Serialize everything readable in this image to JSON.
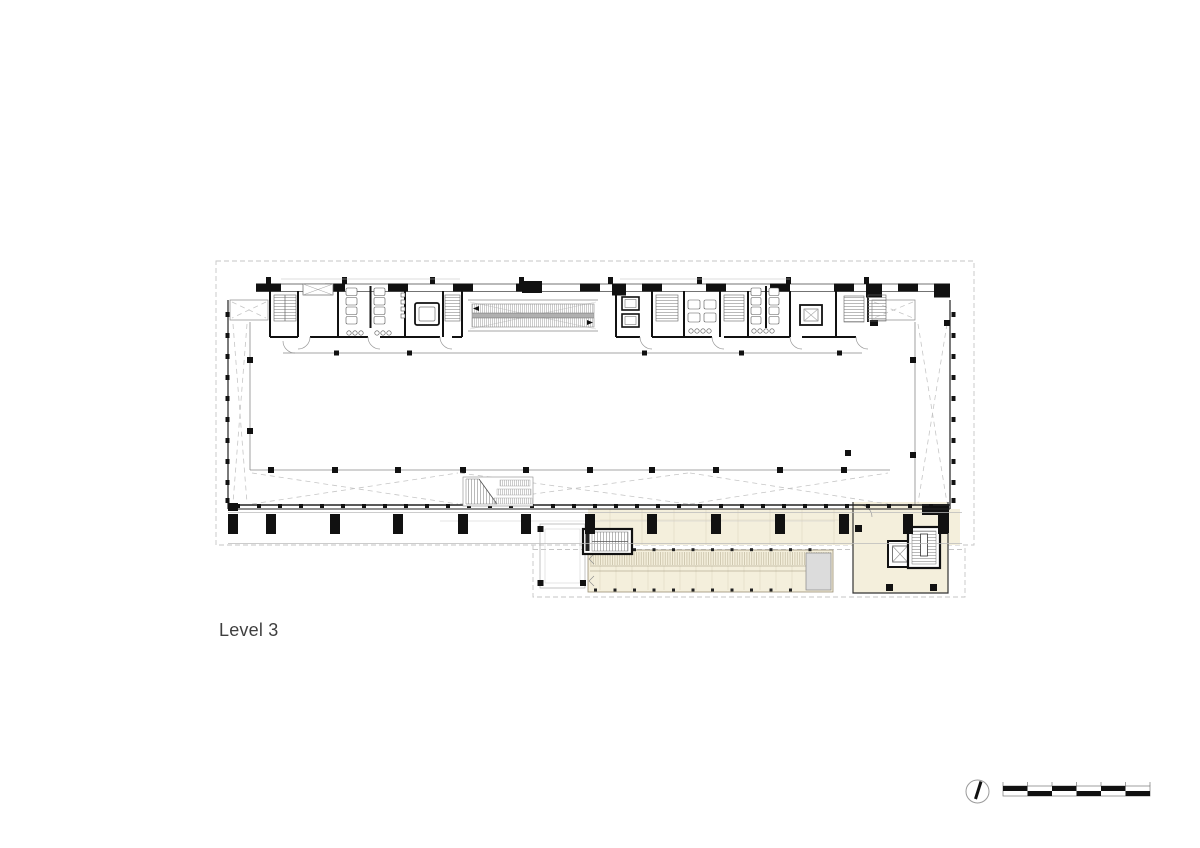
{
  "page": {
    "width": 1200,
    "height": 848,
    "background": "#ffffff"
  },
  "plan": {
    "label": "Level 3",
    "colors": {
      "wall": "#111111",
      "thin_line": "#8a8a8a",
      "dashed_line": "#c6c6c6",
      "terrace_fill": "#f4efdc",
      "louver_line": "#b4ab8e",
      "end_platform_fill": "#dcdcdc",
      "label_text": "#3f3f3f"
    }
  },
  "symbols": {
    "north_arrow": "north-arrow",
    "scale_bar": {
      "divisions": 6
    }
  }
}
